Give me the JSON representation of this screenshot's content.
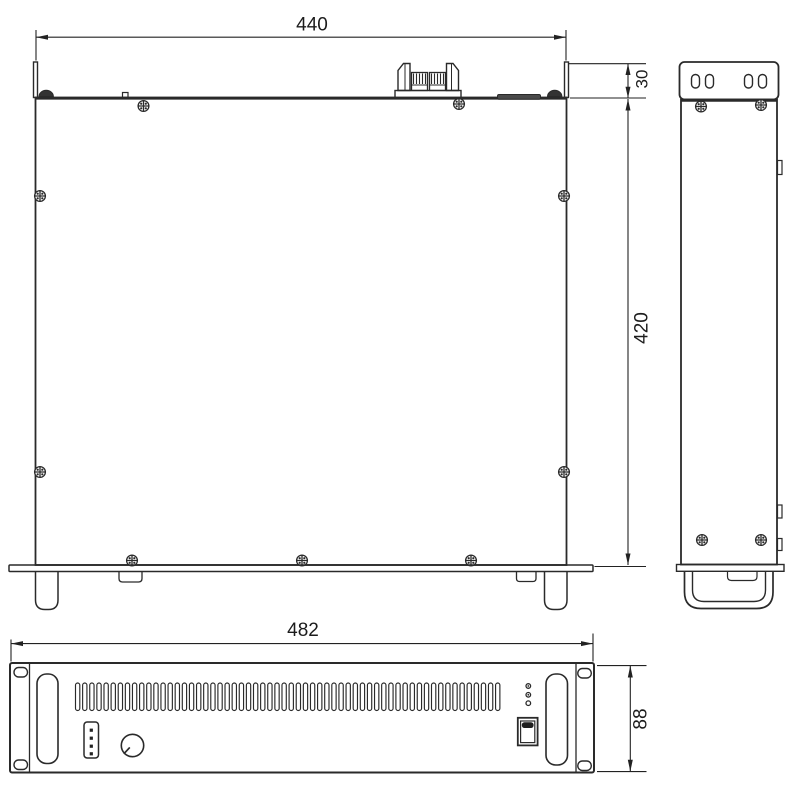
{
  "drawing": {
    "dimensions": {
      "top_view_width": "440",
      "rear_extension_depth": "30",
      "body_depth": "420",
      "front_panel_width": "482",
      "front_panel_height": "88"
    },
    "colors": {
      "line": "#2a2a2a",
      "dimension_line": "#222222",
      "background": "#ffffff",
      "dark_fill": "#3a3a3a"
    },
    "front_panel": {
      "vent_slot_count": 60,
      "led_count": 3,
      "connector_pin_count": 4
    }
  }
}
